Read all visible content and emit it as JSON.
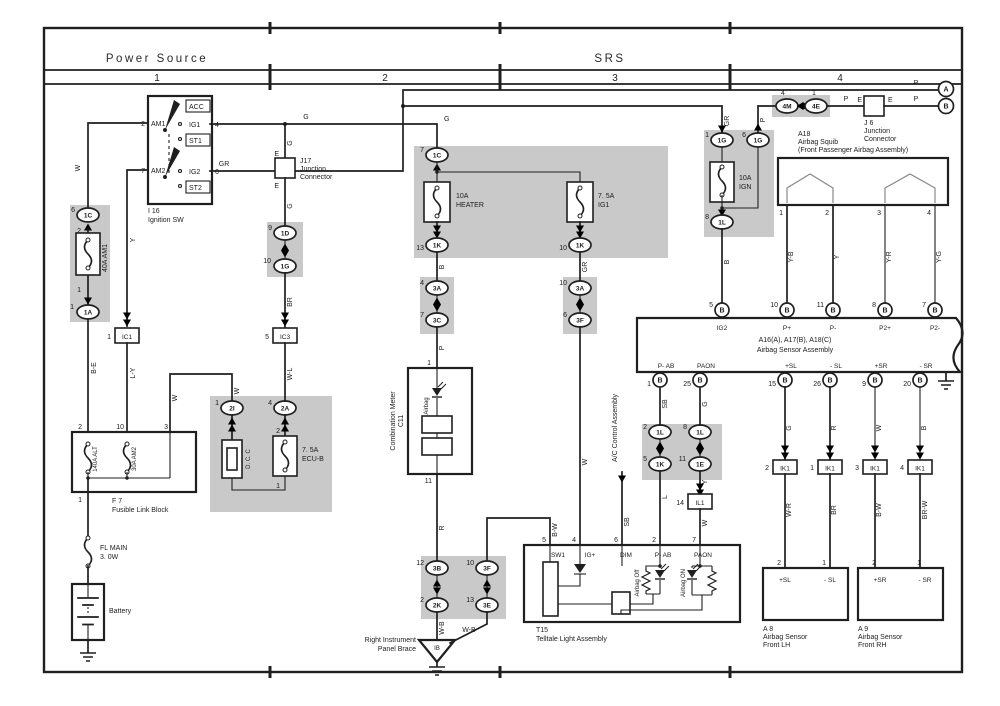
{
  "hdr": {
    "power": "Power Source",
    "srs": "SRS",
    "s1": "1",
    "s2": "2",
    "s3": "3",
    "s4": "4"
  },
  "ign": {
    "id": "I 16",
    "name": "Ignition SW",
    "p2": "2",
    "am1": "AM1",
    "p7": "7",
    "am2": "AM2",
    "acc": "ACC",
    "ig1": "IG1",
    "p4": "4",
    "st1": "ST1",
    "ig2": "IG2",
    "p6": "6",
    "st2": "ST2"
  },
  "j17": {
    "id": "J17",
    "l1": "Junction",
    "l2": "Connector",
    "et": "E",
    "eb": "E"
  },
  "j6": {
    "id": "J 6",
    "l1": "Junction",
    "l2": "Connector",
    "el": "E",
    "er": "E"
  },
  "flb": {
    "id": "F 7",
    "name": "Fusible Link Block",
    "p2": "2",
    "p10": "10",
    "p3": "3",
    "p1": "1",
    "alt": "140A ALT",
    "am2": "30A AM2"
  },
  "flm": {
    "l1": "FL MAIN",
    "l2": "3. 0W"
  },
  "bat": {
    "name": "Battery"
  },
  "dcc": {
    "name": "D. C. C"
  },
  "fuse": {
    "am1": {
      "r": "40A AM1",
      "p2": "2",
      "p1": "1"
    },
    "ecub": {
      "l1": "7. 5A",
      "l2": "ECU-B",
      "p2": "2",
      "p1": "1"
    },
    "htr": {
      "l1": "10A",
      "l2": "HEATER"
    },
    "ig1": {
      "l1": "7. 5A",
      "l2": "IG1"
    },
    "ign": {
      "l1": "10A",
      "l2": "IGN"
    }
  },
  "mtr": {
    "id": "C11",
    "name": "Combination Meter",
    "p1": "1",
    "p11": "11",
    "lamp": "Airbag"
  },
  "tla": {
    "id": "T15",
    "name": "Telltale Light Assembly",
    "p5": "5",
    "p4": "4",
    "p6": "6",
    "p2": "2",
    "p7": "7",
    "sw1": "SW1",
    "ig": "IG+",
    "dim": "DIM",
    "pab": "P- AB",
    "paon": "PAON",
    "off": "Airbag Off",
    "on": "Airbag ON"
  },
  "gndib": {
    "id": "IB",
    "l1": "Right Instrument",
    "l2": "Panel Brace"
  },
  "ac": {
    "name": "A/C Control Assembly"
  },
  "sq": {
    "id": "A18",
    "l1": "Airbag Squib",
    "l2": "(Front Passenger Airbag Assembly)",
    "p1": "1",
    "p2": "2",
    "p3": "3",
    "p4": "4"
  },
  "asa": {
    "id": "A16(A), A17(B), A18(C)",
    "name": "Airbag Sensor Assembly",
    "b": "B",
    "ig2": "IG2",
    "pp": "P+",
    "pm": "P-",
    "p2p": "P2+",
    "p2m": "P2-",
    "pab": "P- AB",
    "paon": "PAON",
    "slp": "+SL",
    "slm": "- SL",
    "srp": "+SR",
    "srm": "- SR",
    "t5": "5",
    "t10": "10",
    "t11": "11",
    "t8": "8",
    "t7": "7",
    "b1": "1",
    "b25": "25",
    "b15": "15",
    "b26": "26",
    "b9": "9",
    "b20": "20"
  },
  "lh": {
    "id": "A 8",
    "l1": "Airbag Sensor",
    "l2": "Front LH",
    "p2": "2",
    "p1": "1",
    "sp": "+SL",
    "sm": "- SL"
  },
  "rh": {
    "id": "A 9",
    "l1": "Airbag Sensor",
    "l2": "Front RH",
    "p2": "2",
    "p1": "1",
    "sp": "+SR",
    "sm": "- SR"
  },
  "cir": {
    "a": "A",
    "b": "B"
  },
  "conn": {
    "c1c6": {
      "pin": "6",
      "id": "1C"
    },
    "c1a": {
      "pin": "1",
      "id": "1A"
    },
    "ic1": {
      "pin": "1",
      "id": "IC1"
    },
    "c1d": {
      "pin": "9",
      "id": "1D"
    },
    "c1g10": {
      "pin": "10",
      "id": "1G"
    },
    "ic3": {
      "pin": "5",
      "id": "IC3"
    },
    "c2i": {
      "pin": "1",
      "id": "2I"
    },
    "c2a": {
      "pin": "4",
      "id": "2A"
    },
    "c1c7": {
      "pin": "7",
      "id": "1C"
    },
    "c1k13": {
      "pin": "13",
      "id": "1K"
    },
    "c1k10": {
      "pin": "10",
      "id": "1K"
    },
    "c3a4": {
      "pin": "4",
      "id": "3A"
    },
    "c3c7": {
      "pin": "7",
      "id": "3C"
    },
    "c3a10": {
      "pin": "10",
      "id": "3A"
    },
    "c3f6": {
      "pin": "6",
      "id": "3F"
    },
    "c3b12": {
      "pin": "12",
      "id": "3B"
    },
    "c2k2": {
      "pin": "2",
      "id": "2K"
    },
    "c3f10": {
      "pin": "10",
      "id": "3F"
    },
    "c3e13": {
      "pin": "13",
      "id": "3E"
    },
    "c1g1": {
      "pin": "1",
      "id": "1G"
    },
    "c1g6": {
      "pin": "6",
      "id": "1G"
    },
    "c1l8": {
      "pin": "8",
      "id": "1L"
    },
    "c4m": {
      "pin": "4",
      "id": "4M"
    },
    "c4e": {
      "pin": "1",
      "id": "4E"
    },
    "c1l2": {
      "pin": "2",
      "id": "1L"
    },
    "c1k5": {
      "pin": "5",
      "id": "1K"
    },
    "c1l8b": {
      "pin": "8",
      "id": "1L"
    },
    "c1e11": {
      "pin": "11",
      "id": "1E"
    },
    "il1": {
      "pin": "14",
      "id": "IL1"
    },
    "ik1a": {
      "pin": "2",
      "id": "IK1"
    },
    "ik1b": {
      "pin": "1",
      "id": "IK1"
    },
    "ik1c": {
      "pin": "3",
      "id": "IK1"
    },
    "ik1d": {
      "pin": "4",
      "id": "IK1"
    }
  },
  "w": {
    "w1": "W",
    "y1": "Y",
    "be": "B-E",
    "ly": "L-Y",
    "g1": "G",
    "g2": "G",
    "gr1": "GR",
    "gj1": "G",
    "gj2": "G",
    "br1": "BR",
    "wl": "W-L",
    "w2": "W",
    "w3": "W",
    "b1": "B",
    "gr2": "GR",
    "p1": "P",
    "w4": "W",
    "r1": "R",
    "wb1": "W-B",
    "wb2": "W-B",
    "bw1": "B-W",
    "sb1": "SB",
    "g3": "G",
    "l1": "L",
    "y2": "Y",
    "w5": "W",
    "sb2": "SB",
    "gr3": "GR",
    "b2": "B",
    "p2": "P",
    "p3": "P",
    "p4": "P",
    "p5": "P",
    "yb1": "Y-B",
    "y3": "Y",
    "yr1": "Y-R",
    "yg1": "Y-G",
    "g4": "G",
    "r2": "R",
    "w6": "W",
    "b3": "B",
    "wr1": "W-R",
    "br2": "BR",
    "bw2": "B-W",
    "brw1": "BR-W"
  }
}
